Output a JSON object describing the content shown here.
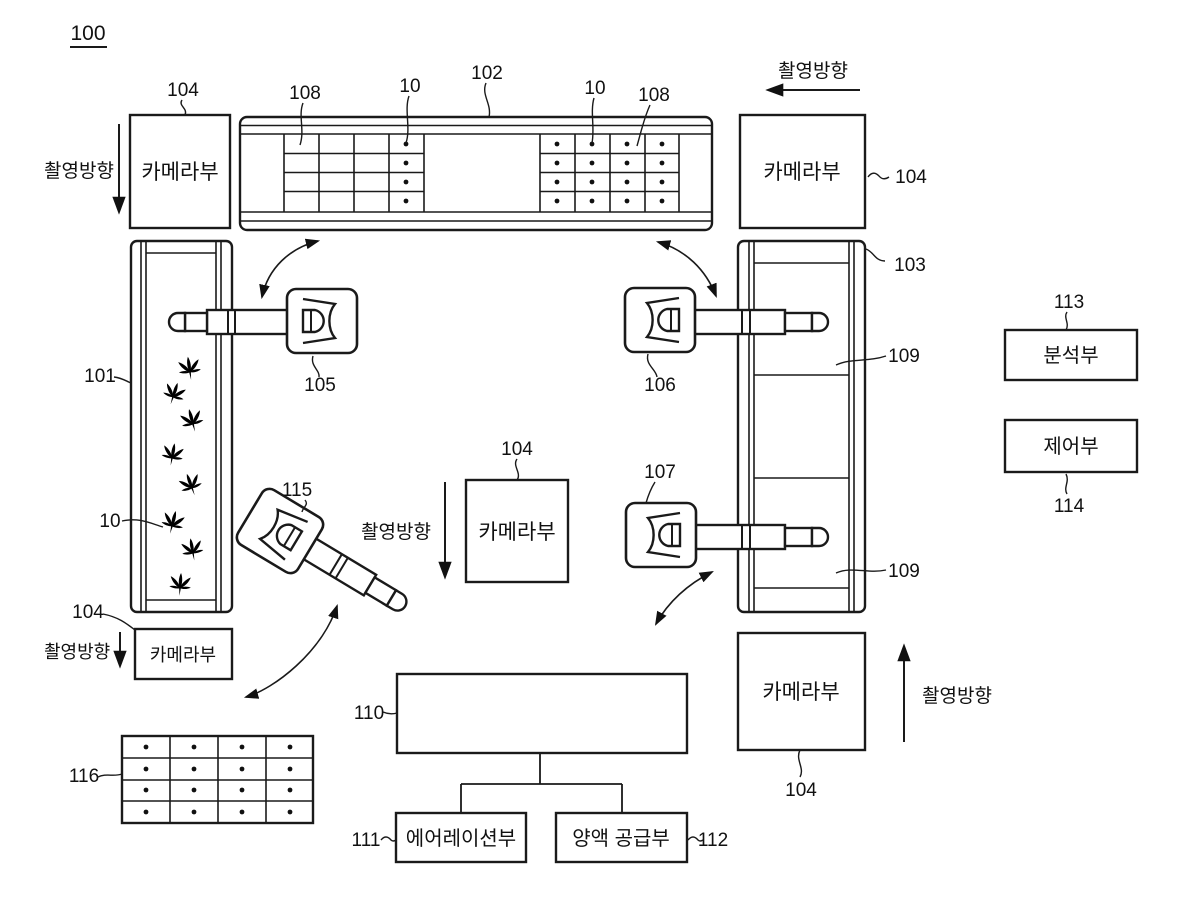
{
  "figure": {
    "title_ref": "100"
  },
  "text": {
    "camera_unit": "카메라부",
    "shoot_direction": "촬영방향",
    "analysis_unit": "분석부",
    "control_unit": "제어부",
    "aeration_unit": "에어레이션부",
    "nutrient_supply_unit": "양액 공급부"
  },
  "refs": {
    "system": "100",
    "first_conveyor": "101",
    "second_conveyor": "102",
    "third_conveyor": "103",
    "camera_unit": "104",
    "robot_105": "105",
    "robot_106": "106",
    "robot_107": "107",
    "tray": "108",
    "plant": "10",
    "bed": "109",
    "tank": "110",
    "aeration": "111",
    "nutrient": "112",
    "analysis": "113",
    "control": "114",
    "robot_115": "115",
    "out_tray": "116"
  },
  "colors": {
    "line": "#1a1a1a",
    "background": "#ffffff",
    "plant": "#000000"
  }
}
